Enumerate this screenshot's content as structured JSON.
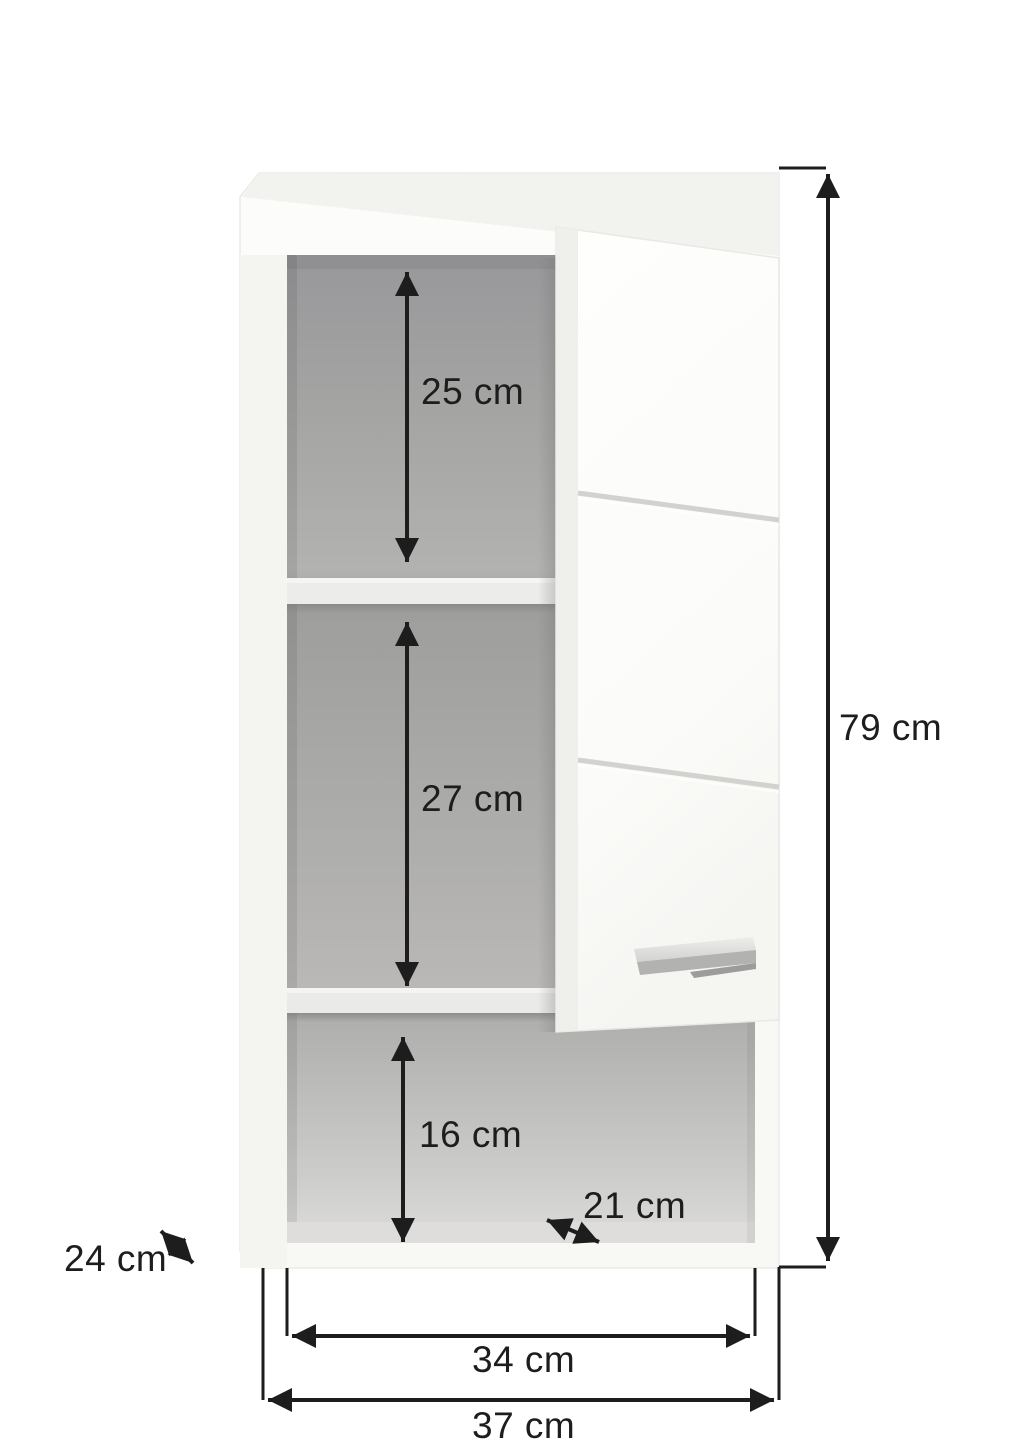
{
  "diagram": {
    "kind": "furniture dimension drawing",
    "subject": "wall-mounted cabinet with open door and two inner shelves",
    "background_color": "#ffffff",
    "dimension_line_color": "#1d1d1d",
    "cabinet_colors": {
      "body_white": "#f8f8f5",
      "top_face": "#f2f2ef",
      "front_band": "#fcfcfa",
      "interior_gray_top": "#9a9a98",
      "interior_gray_bottom": "#dcdcda",
      "shelf": "#ececea",
      "door_face": "#fdfdfb",
      "door_edge": "#efefec",
      "handle_silver": "#b5b5b3"
    }
  },
  "labels": {
    "top_compartment_height": "25 cm",
    "middle_compartment_height": "27 cm",
    "bottom_compartment_height": "16 cm",
    "bottom_shelf_depth": "21 cm",
    "cabinet_depth": "24 cm",
    "total_height": "79 cm",
    "inner_width": "34 cm",
    "outer_width": "37 cm"
  }
}
